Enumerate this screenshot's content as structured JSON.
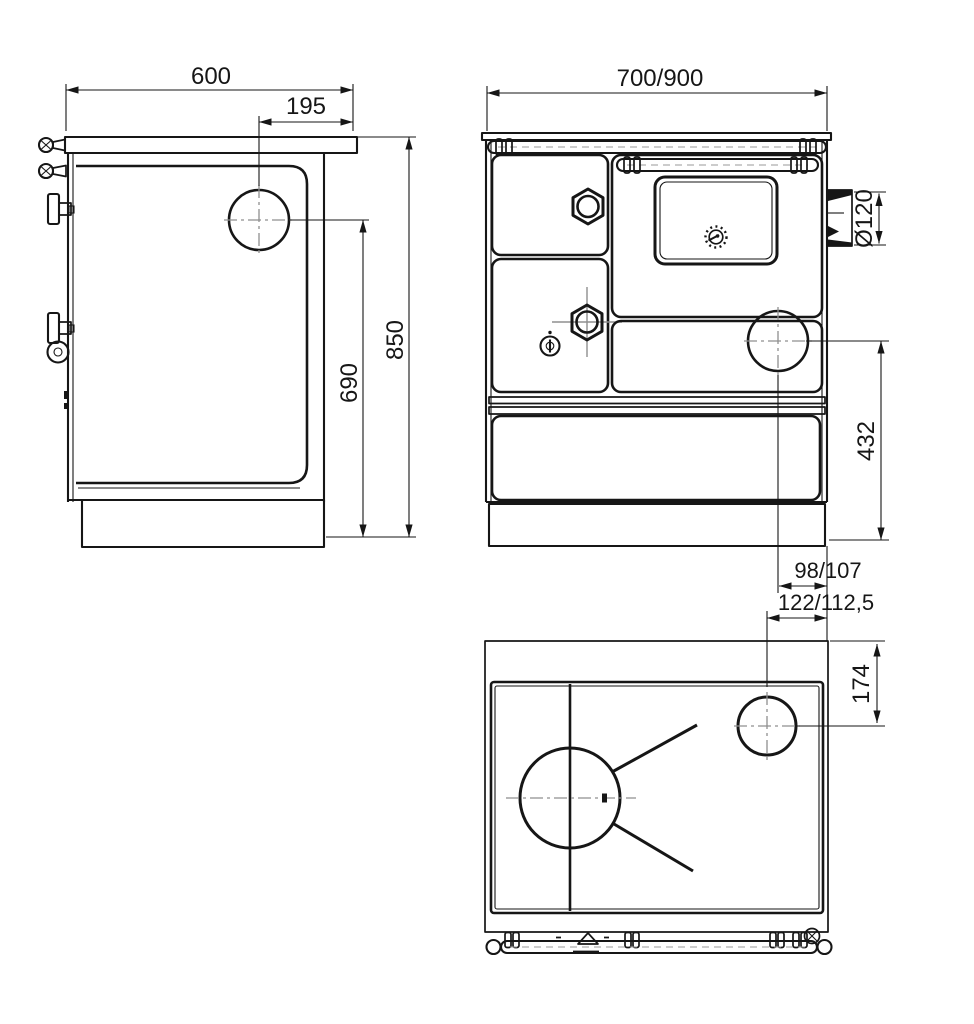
{
  "drawing": {
    "background": "#ffffff",
    "line_color": "#161616",
    "centerline_color": "#8f8f8f",
    "dimensions": {
      "side_overall_width": "600",
      "side_hotplate_offset": "195",
      "overall_height": "850",
      "hotplate_center_height": "690",
      "front_overall_width": "700/900",
      "flue_diameter": "Ø120",
      "flue_center_height": "432",
      "flue_offset_front": "98/107",
      "flue_offset_top": "122/112,5",
      "flue_depth_offset": "174"
    }
  }
}
